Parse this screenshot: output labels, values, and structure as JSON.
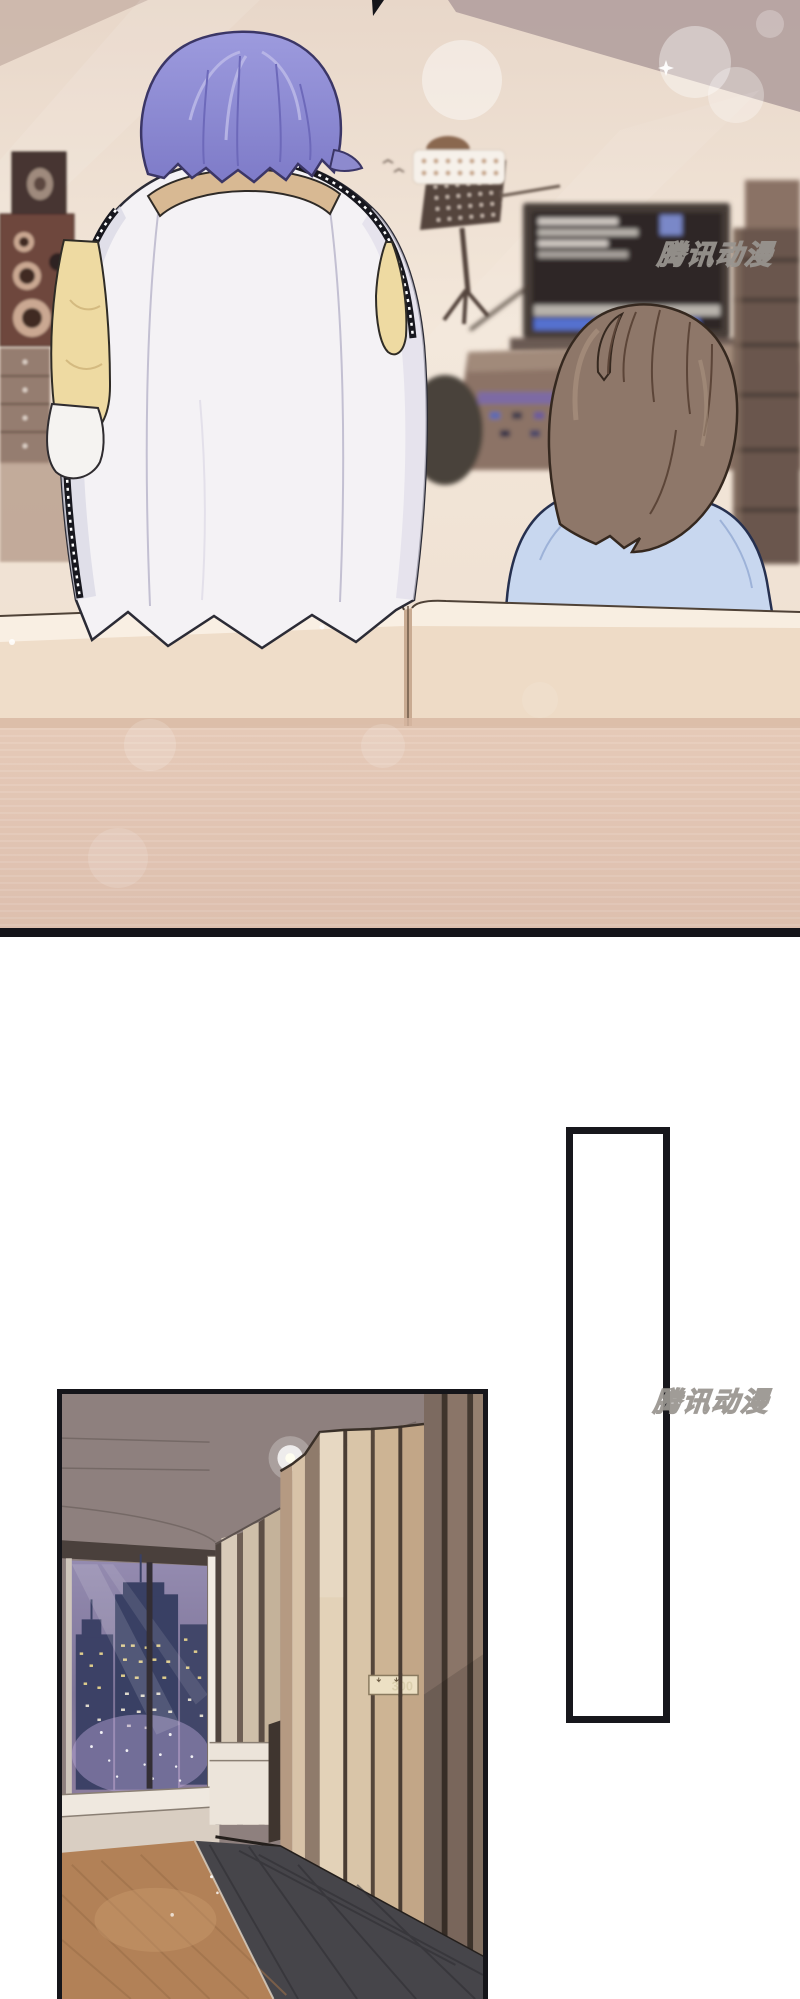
{
  "page": {
    "width": 800,
    "height": 1999,
    "background": "#ffffff",
    "kind": "comic-page"
  },
  "watermark": {
    "text": "腾讯动漫",
    "fill": "#ffffff",
    "outline": "#999590",
    "positions": [
      {
        "x": 660,
        "y": 235
      },
      {
        "x": 656,
        "y": 1383
      }
    ]
  },
  "speech_bubble": {
    "text": "",
    "shape": "tall-rectangle",
    "border_color": "#17171c",
    "fill": "#ffffff",
    "x": 566,
    "y": 1127,
    "w": 104,
    "h": 596
  },
  "door_sign": {
    "text": "300"
  },
  "panels": [
    {
      "id": "studio",
      "label": "recording-studio-scene",
      "bounds": {
        "x": 0,
        "y": 0,
        "w": 800,
        "h": 937
      },
      "colors": {
        "wall": "#f0e2d4",
        "ceiling_shadow": "#b3a19f",
        "couch_back": "#efddc9",
        "couch_base": "#e0c2b0",
        "bottom_border": "#14141a",
        "speaker": "#6e463c",
        "monitor_screen": "#2e2827"
      },
      "characters": [
        {
          "id": "character-purple-hair",
          "pose": "standing-back-view",
          "hair_color": "#8f8cd1",
          "jacket_color": "#f4f2f5",
          "sleeve_color": "#eedaa2",
          "collar_color": "#d8b993"
        },
        {
          "id": "character-brown-hair",
          "pose": "seated-looking-back",
          "hair_color": "#8e7769",
          "shirt_color": "#c8d7ef",
          "eye_color": "#4f9f3a"
        }
      ]
    },
    {
      "id": "hallway",
      "label": "hotel-corridor-scene",
      "bounds": {
        "x": 57,
        "y": 1389,
        "w": 431,
        "h": 610
      },
      "colors": {
        "ceiling": "#8e807e",
        "wood_light": "#e3d2b8",
        "wood_dark": "#8a7568",
        "carpet": "#b28157",
        "floor_dark": "#46454a",
        "night_sky": "#8a81a6",
        "buildings": "#3c4166",
        "window_frame": "#f1ebe3"
      },
      "door_sign": "300"
    }
  ]
}
